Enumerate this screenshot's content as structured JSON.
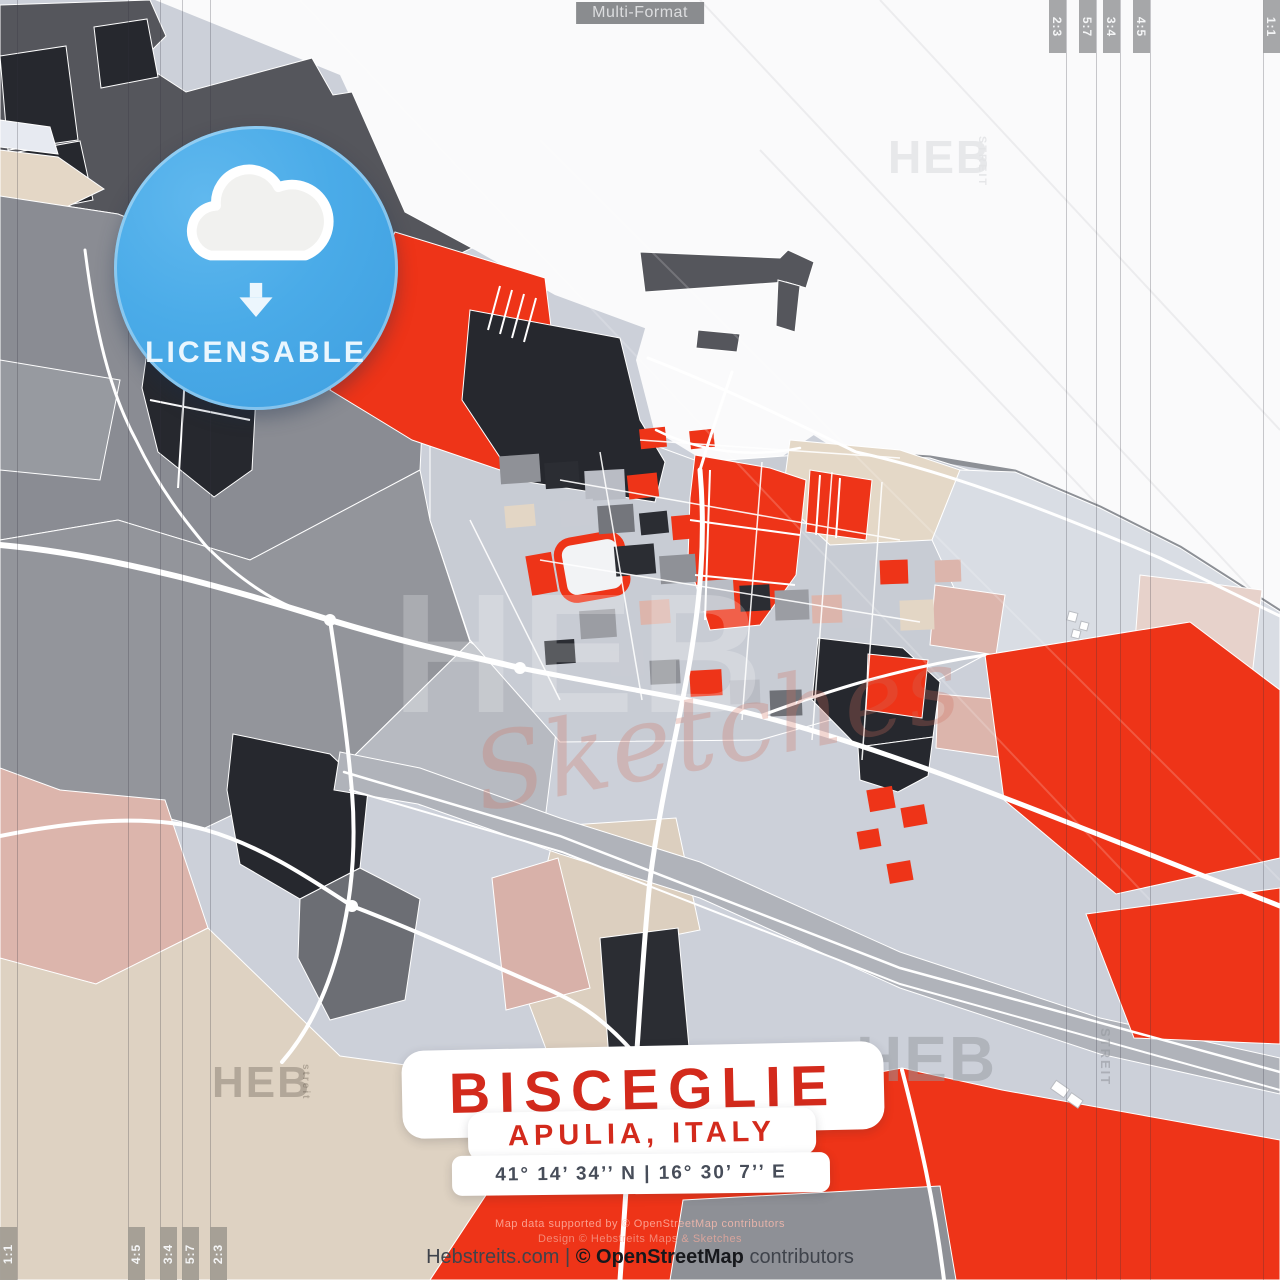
{
  "header": {
    "format_label": "Multi-Format"
  },
  "format_marks": {
    "top": [
      "2:3",
      "5:7",
      "3:4",
      "4:5",
      "1:1"
    ],
    "bottom": [
      "1:1",
      "4:5",
      "3:4",
      "5:7",
      "2:3"
    ]
  },
  "badge": {
    "label": "LICENSABLE",
    "icon": "cloud-download-icon"
  },
  "title_block": {
    "city": "BISCEGLIE",
    "region": "APULIA, ITALY",
    "coordinates": "41° 14’ 34’’ N | 16° 30’ 7’’ E"
  },
  "footer": {
    "site": "Hebstreits.com",
    "divider": "|",
    "osm": "© OpenStreetMap",
    "contributors": "contributors",
    "fineprint_line1": "Map data supported by © OpenStreetMap contributors",
    "fineprint_line2": "Design © Hebstreits Maps & Sketches"
  },
  "watermarks": {
    "heb": "HEB",
    "streit": "STREIT",
    "streit_small": "streit",
    "sketches": "Sketches"
  },
  "colors": {
    "accent_red": "#ee3418",
    "badge_blue": "#47a8e6",
    "map_black": "#26282e",
    "map_dark_gray": "#55565c",
    "sea_white": "#fafafb"
  }
}
